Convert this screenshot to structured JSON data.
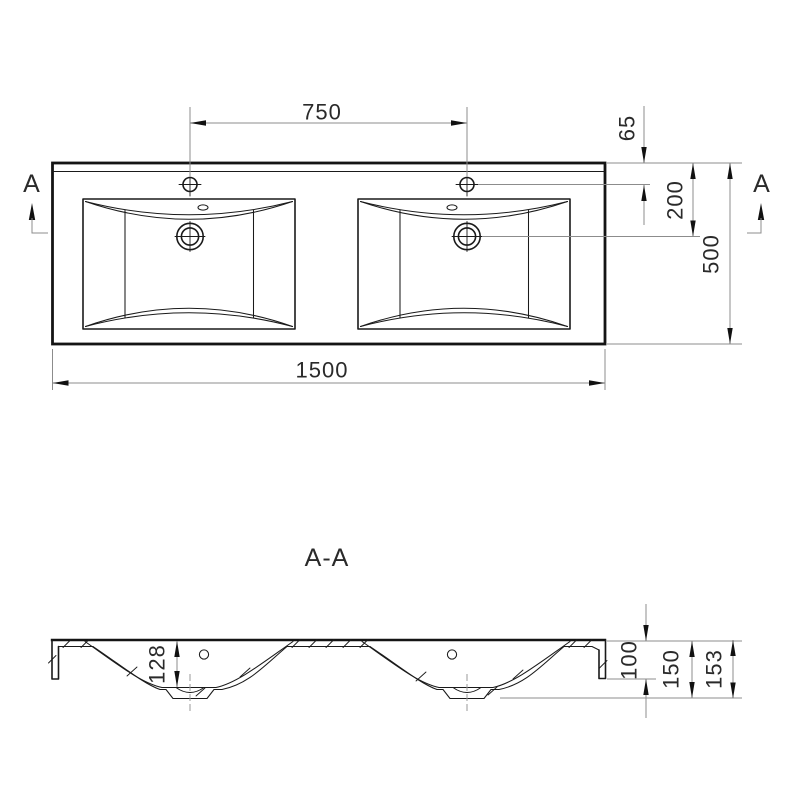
{
  "top_view": {
    "section_label_left": "A",
    "section_label_right": "A",
    "dim_faucet_spacing": "750",
    "dim_overall_width": "1500",
    "dim_hole_offset_from_back": "65",
    "dim_drain_offset_from_back": "200",
    "dim_overall_depth": "500"
  },
  "section_view": {
    "title": "A-A",
    "dim_bowl_depth": "128",
    "dim_rim_height": "100",
    "dim_body_height": "150",
    "dim_overall_height": "153"
  },
  "colors": {
    "outline": "#141414",
    "dimension_line": "#8c8c8c",
    "text": "#2a2a2a",
    "background": "#ffffff"
  }
}
